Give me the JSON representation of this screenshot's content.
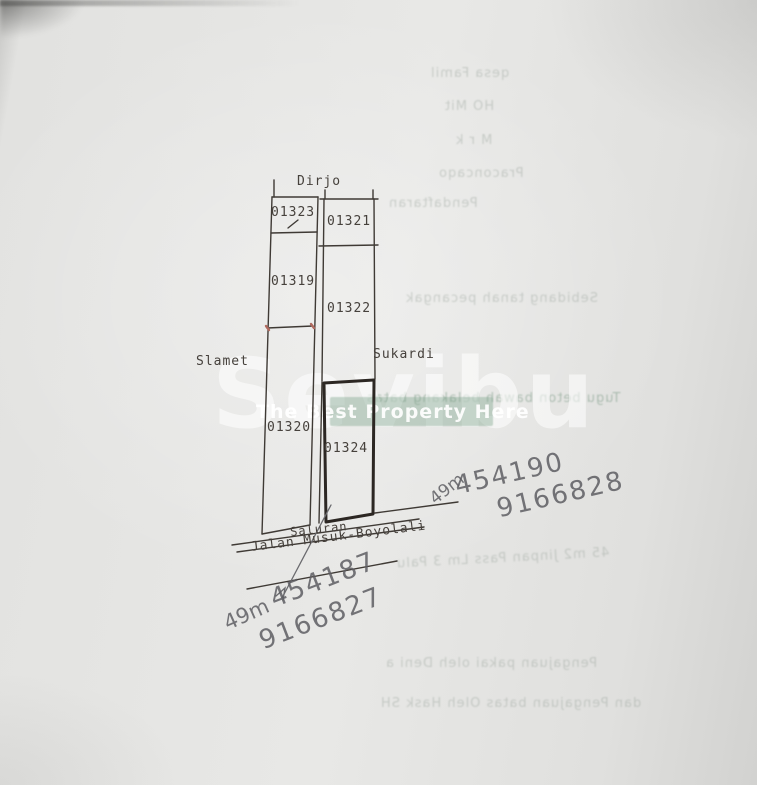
{
  "document_type": "photographed land-sketch page",
  "watermark": {
    "brand": "Sevibu",
    "tagline": "The Best Property Here",
    "band_color": "#749e84"
  },
  "diagram": {
    "top_neighbor": "Dirjo",
    "left_neighbor": "Slamet",
    "right_neighbor": "Sukardi",
    "channel_label": "Saluran",
    "road_label": "Jalan Musuk-Boyolali",
    "parcels": [
      {
        "id": "01323",
        "strip": "left"
      },
      {
        "id": "01319",
        "strip": "left"
      },
      {
        "id": "01320",
        "strip": "left"
      },
      {
        "id": "01321",
        "strip": "right"
      },
      {
        "id": "01322",
        "strip": "right"
      },
      {
        "id": "01324",
        "strip": "right",
        "highlighted": true
      }
    ],
    "line_color": "#3f3a35",
    "highlight_line_color": "#2c2723",
    "tick_color": "#b06a5f"
  },
  "annotations": {
    "right": {
      "distance": "49m",
      "easting": "454190",
      "northing": "9166828"
    },
    "bottom": {
      "distance": "49m",
      "easting": "454187",
      "northing": "9166827"
    },
    "ink_color": "#5e5e63"
  },
  "bleedthrough": {
    "lines": [
      {
        "text": "qesa Famil"
      },
      {
        "text": "HO Mit"
      },
      {
        "text": "M r k"
      },
      {
        "text": "Praconcaqo"
      },
      {
        "text": "Pendaftaran"
      },
      {
        "text": "Sebidang tanah pecangak"
      },
      {
        "text": "Tugu beton bawah belakang batas"
      },
      {
        "text": "45 m2 Jinpan Pass Lm 3 Palu"
      },
      {
        "text": "Pengajuan pakai oleh Deni a"
      },
      {
        "text": "dan Pengajuan batas Oleh Hask SH"
      }
    ]
  }
}
